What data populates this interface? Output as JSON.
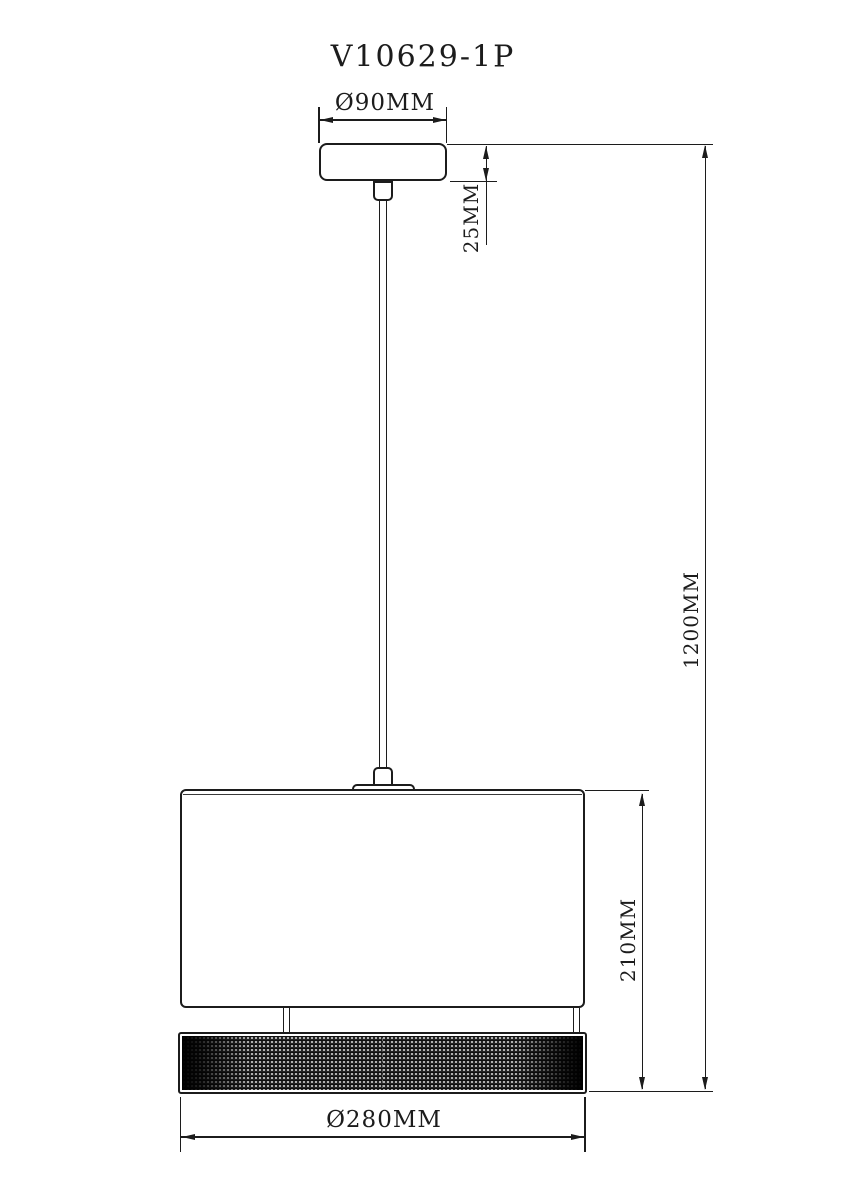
{
  "title": "V10629-1P",
  "dimensions": {
    "canopy_diameter": "Ø90MM",
    "canopy_height": "25MM",
    "overall_height": "1200MM",
    "shade_height": "210MM",
    "shade_diameter": "Ø280MM"
  },
  "colors": {
    "line": "#1c1c1c",
    "background": "#ffffff"
  }
}
